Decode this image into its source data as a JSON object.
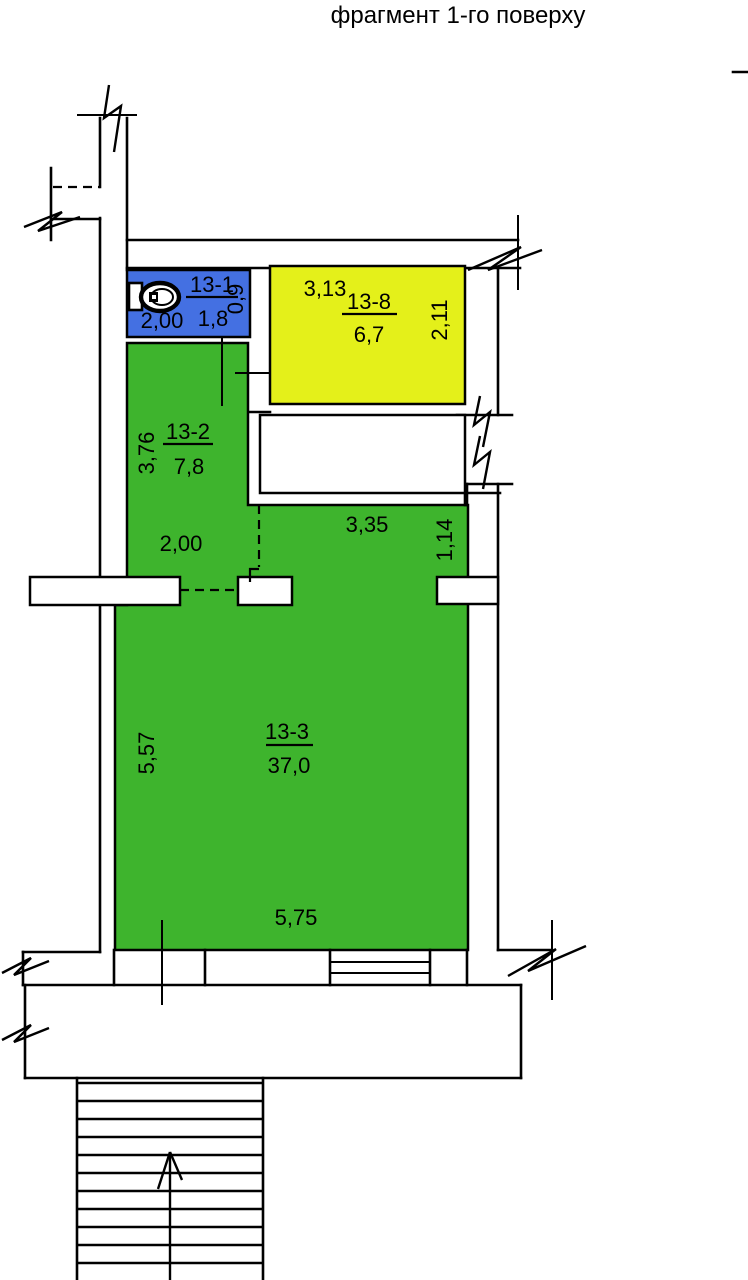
{
  "title": "фрагмент 1-го поверху",
  "colors": {
    "wc_room": "#4470E2",
    "storage_room": "#E4F01A",
    "living_rooms": "#3EB42D"
  },
  "rooms": {
    "wc": {
      "id": "13-1",
      "area": "1,8"
    },
    "storage": {
      "id": "13-8",
      "area": "6,7"
    },
    "hall": {
      "id": "13-2",
      "area": "7,8"
    },
    "main": {
      "id": "13-3",
      "area": "37,0"
    }
  },
  "dimensions": {
    "wc_width": "2,00",
    "wc_depth": "0,9",
    "storage_width": "3,13",
    "storage_depth": "2,11",
    "hall_height": "3,76",
    "hall_width": "2,00",
    "corridor_width": "3,35",
    "corridor_depth": "1,14",
    "main_height": "5,57",
    "main_width": "5,75"
  }
}
